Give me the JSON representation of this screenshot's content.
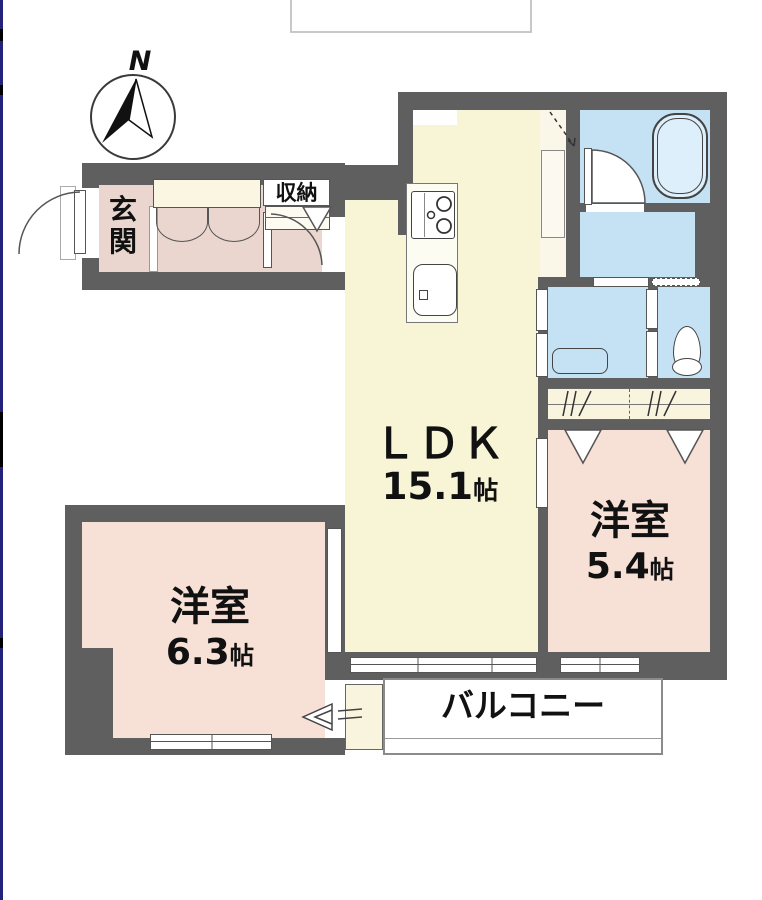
{
  "compass": {
    "label": "N"
  },
  "rooms": {
    "ldk": {
      "label": "ＬＤＫ",
      "size": "15.1",
      "unit": "帖"
    },
    "bedroom_a": {
      "label": "洋室",
      "size": "5.4",
      "unit": "帖"
    },
    "bedroom_b": {
      "label": "洋室",
      "size": "6.3",
      "unit": "帖"
    },
    "entrance": {
      "label": "玄関"
    },
    "storage": {
      "label": "収納"
    },
    "balcony": {
      "label": "バルコニー"
    }
  },
  "colors": {
    "wall": "#5f5f5f",
    "ldk_floor": "#f8f5d7",
    "hall_floor": "#faf7e8",
    "bedroom_floor": "#f7e0d6",
    "entrance_floor": "#ead6ce",
    "wet_area": "#c5e2f4",
    "closet_floor": "#f8f4dd",
    "accent_line": "#23227a"
  }
}
